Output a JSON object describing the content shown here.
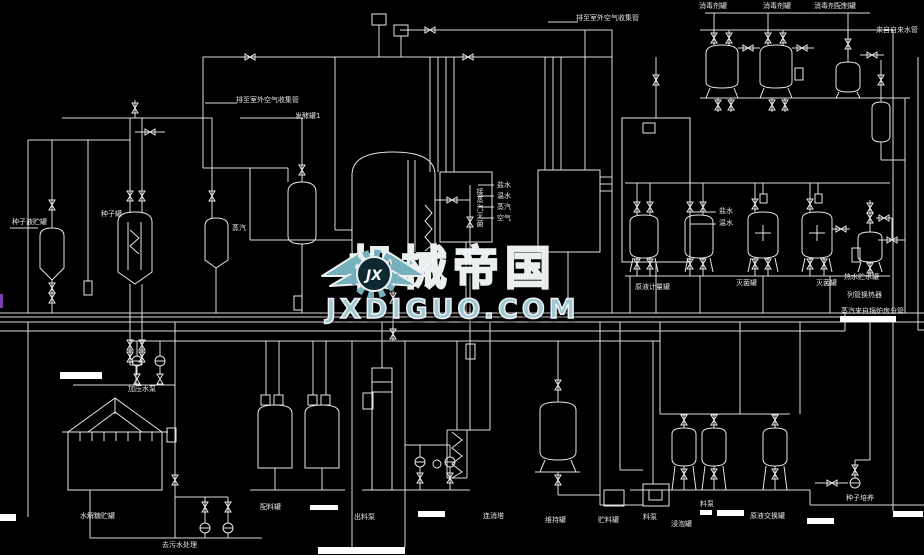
{
  "page": {
    "background_color": "#000000",
    "line_color": "#dcdcdc",
    "type": "fermentation-process-pid-cad-drawing"
  },
  "watermark": {
    "logo_initials": "JX",
    "title": "机械帝国",
    "url": "JXDIGUO.COM",
    "accent_color": "#7ab6c4"
  },
  "labels": [
    "排至室外空气收集管",
    "排至室外空气收集管",
    "发酵罐1",
    "种子液贮罐",
    "种子罐",
    "消毒剂罐",
    "消毒剂罐",
    "消毒剂配制罐",
    "来自自来水管",
    "盐水",
    "温水",
    "蒸汽",
    "空气",
    "盐水",
    "温水",
    "原液计量罐",
    "灭菌罐",
    "灭菌罐",
    "热水贮水罐",
    "列管换热器",
    "蒸汽来自锅炉房分管",
    "接蒸汽灭菌",
    "水解糖贮罐",
    "去污水处理",
    "加压水泵",
    "配料罐",
    "出料泵",
    "连消塔",
    "维持罐",
    "贮料罐",
    "料泵",
    "浸泡罐",
    "料泵",
    "原液交换罐",
    "种子培养",
    "蒸汽"
  ]
}
